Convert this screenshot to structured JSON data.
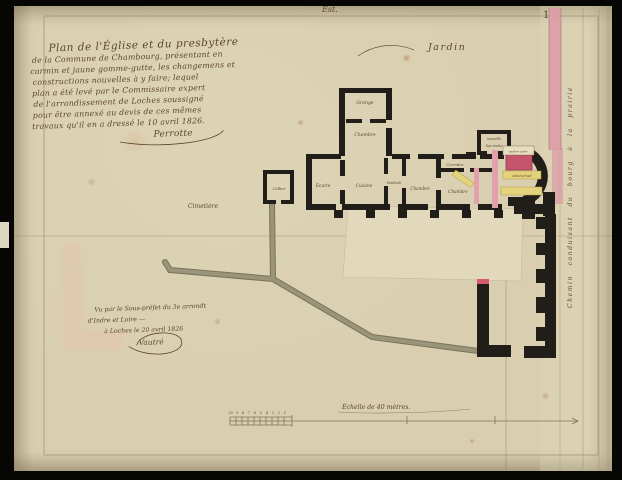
{
  "page": {
    "orientation_label": "Est.",
    "page_number": "1"
  },
  "title_block": {
    "lines": [
      "Plan de l'Église et du presbytère",
      "de la Commune de Chambourg, présentant en",
      "carmin et jaune gomme-gutte, les changemens et",
      "constructions nouvelles à y faire; lequel",
      "plan a été levé par le Commissaire expert",
      "de l'arrondissement de Loches soussigné",
      "pour être annexé au devis de ces mêmes",
      "travaux qu'il en a dressé le 10 avril 1826."
    ],
    "signature": "Perrotte"
  },
  "visa_block": {
    "lines": [
      "Vu par le Sous-préfet du 3e arrondt",
      "d'Indre et Loire —",
      "à Loches le 20 avril 1826"
    ],
    "signature": "Vautré"
  },
  "plan": {
    "areas": {
      "jardin": "Jardin",
      "cimetiere": "Cimetière",
      "chemin_vertical": "Chemin conduisant du bourg à la prairie"
    },
    "rooms": {
      "grange": "Grange",
      "chambre_nord": "Chambre",
      "cellier": "Cellier",
      "ecurie": "Écurie",
      "cuisine": "Cuisine",
      "vestibule": "Vestibule",
      "chambre_centre": "Chambre",
      "corridor": "Corridor",
      "chambre_est": "Chambre",
      "sacristie_ligne1": "nouvelle",
      "sacristie_ligne2": "Sacristie"
    },
    "annotations": {
      "maitre_autel": "maître autel",
      "autel_actuel": "autel actuel"
    }
  },
  "scale_bar": {
    "caption": "Échelle de 40 mètres.",
    "subdivision_numbers": [
      "10",
      "9",
      "8",
      "7",
      "6",
      "5",
      "4",
      "3",
      "2",
      "1"
    ]
  },
  "colors": {
    "paper": "#d9cfb0",
    "ink_wall": "#211d18",
    "ink_text": "#5d462f",
    "carmine": "#c4556b",
    "pink_wash": "#e2a0ac",
    "gamboge_yellow": "#e4d37d",
    "road_grey": "#8d8872"
  }
}
